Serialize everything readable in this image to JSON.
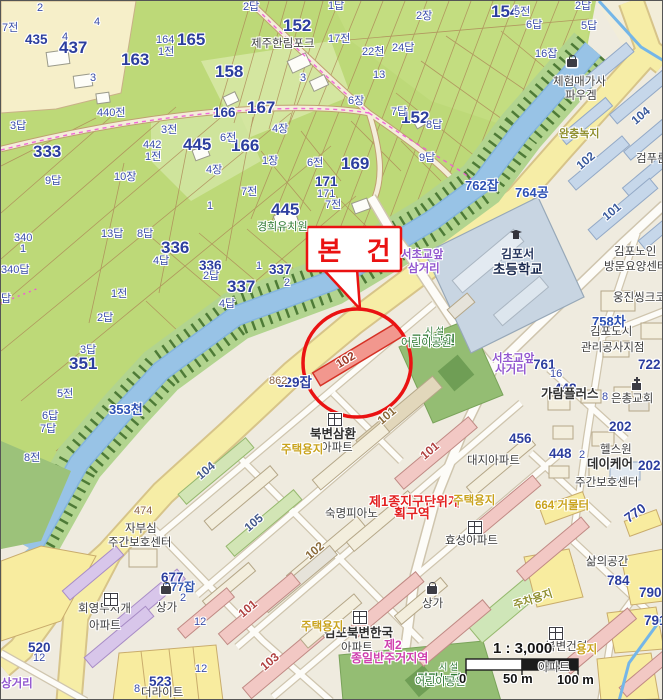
{
  "map": {
    "callout": {
      "label": "본 건"
    },
    "scale": {
      "ratio": "1 : 3,000",
      "zero": "0",
      "mid": "50 m",
      "end": "100 m"
    },
    "palette": {
      "highlight_red": "#ea1212",
      "parcel_fill": "#f2978e",
      "canal_blue": "#98c3e6",
      "farmland_green": "#bdd978",
      "road_yellow": "#f6eda6",
      "parcel_number_blue": "#2c3e9e",
      "zoning_red": "#e32020",
      "zoning_magenta": "#cf3fae",
      "landuse_yellow": "#c9a31d"
    },
    "labels": [
      {
        "t": "437",
        "x": 58,
        "y": 38,
        "c": "pn"
      },
      {
        "t": "435",
        "x": 24,
        "y": 32,
        "c": "pn2"
      },
      {
        "t": "163",
        "x": 120,
        "y": 50,
        "c": "pn"
      },
      {
        "t": "165",
        "x": 176,
        "y": 30,
        "c": "pn"
      },
      {
        "t": "152",
        "x": 282,
        "y": 16,
        "c": "pn"
      },
      {
        "t": "158",
        "x": 214,
        "y": 62,
        "c": "pn"
      },
      {
        "t": "167",
        "x": 246,
        "y": 98,
        "c": "pn"
      },
      {
        "t": "166",
        "x": 230,
        "y": 136,
        "c": "pn"
      },
      {
        "t": "445",
        "x": 182,
        "y": 135,
        "c": "pn"
      },
      {
        "t": "333",
        "x": 32,
        "y": 142,
        "c": "pn"
      },
      {
        "t": "351",
        "x": 68,
        "y": 354,
        "c": "pn"
      },
      {
        "t": "336",
        "x": 160,
        "y": 238,
        "c": "pn"
      },
      {
        "t": "337",
        "x": 226,
        "y": 277,
        "c": "pn"
      },
      {
        "t": "154",
        "x": 490,
        "y": 2,
        "c": "pn"
      },
      {
        "t": "152",
        "x": 400,
        "y": 108,
        "c": "pn"
      },
      {
        "t": "169",
        "x": 340,
        "y": 154,
        "c": "pn"
      },
      {
        "t": "445",
        "x": 270,
        "y": 200,
        "c": "pn"
      },
      {
        "t": "171",
        "x": 314,
        "y": 174,
        "c": "pn2"
      },
      {
        "t": "166",
        "x": 212,
        "y": 105,
        "c": "pn2"
      },
      {
        "t": "336",
        "x": 198,
        "y": 258,
        "c": "pn2"
      },
      {
        "t": "337",
        "x": 268,
        "y": 262,
        "c": "pn2"
      },
      {
        "t": "677",
        "x": 160,
        "y": 570,
        "c": "pn2"
      },
      {
        "t": "677잡",
        "x": 163,
        "y": 580,
        "c": "jmb"
      },
      {
        "t": "523",
        "x": 148,
        "y": 674,
        "c": "pn2"
      },
      {
        "t": "520",
        "x": 27,
        "y": 640,
        "c": "pn2"
      },
      {
        "t": "529잡",
        "x": 276,
        "y": 375,
        "c": "pn2"
      },
      {
        "t": "862",
        "x": 268,
        "y": 375,
        "c": "brn"
      },
      {
        "t": "448",
        "x": 553,
        "y": 381,
        "c": "pn2"
      },
      {
        "t": "448",
        "x": 548,
        "y": 446,
        "c": "pn2"
      },
      {
        "t": "2",
        "x": 578,
        "y": 449,
        "c": "jm"
      },
      {
        "t": "456",
        "x": 508,
        "y": 431,
        "c": "pn2"
      },
      {
        "t": "202",
        "x": 608,
        "y": 419,
        "c": "pn2"
      },
      {
        "t": "202",
        "x": 637,
        "y": 458,
        "c": "pn2"
      },
      {
        "t": "761",
        "x": 532,
        "y": 357,
        "c": "pn2"
      },
      {
        "t": "722",
        "x": 637,
        "y": 357,
        "c": "pn2"
      },
      {
        "t": "770",
        "x": 625,
        "y": 512,
        "c": "pn2",
        "r": -35
      },
      {
        "t": "784",
        "x": 606,
        "y": 573,
        "c": "pn2"
      },
      {
        "t": "790",
        "x": 638,
        "y": 585,
        "c": "pn2"
      },
      {
        "t": "791",
        "x": 643,
        "y": 613,
        "c": "pn2"
      },
      {
        "t": "353천",
        "x": 108,
        "y": 402,
        "c": "blw"
      },
      {
        "t": "762잡",
        "x": 464,
        "y": 178,
        "c": "blw"
      },
      {
        "t": "764공",
        "x": 514,
        "y": 185,
        "c": "blw"
      },
      {
        "t": "758차",
        "x": 591,
        "y": 314,
        "c": "blw"
      },
      {
        "t": "7전",
        "x": 1,
        "y": 22,
        "c": "jm"
      },
      {
        "t": "2답",
        "x": 242,
        "y": 1,
        "c": "jm"
      },
      {
        "t": "2",
        "x": 36,
        "y": 2,
        "c": "jm"
      },
      {
        "t": "3답",
        "x": 9,
        "y": 120,
        "c": "jm"
      },
      {
        "t": "440전",
        "x": 96,
        "y": 107,
        "c": "jm"
      },
      {
        "t": "3전",
        "x": 160,
        "y": 124,
        "c": "jm"
      },
      {
        "t": "9답",
        "x": 44,
        "y": 175,
        "c": "jm"
      },
      {
        "t": "10장",
        "x": 113,
        "y": 171,
        "c": "jm"
      },
      {
        "t": "7전",
        "x": 240,
        "y": 186,
        "c": "jm"
      },
      {
        "t": "4장",
        "x": 271,
        "y": 123,
        "c": "jm"
      },
      {
        "t": "6전",
        "x": 219,
        "y": 132,
        "c": "jm"
      },
      {
        "t": "1장",
        "x": 261,
        "y": 155,
        "c": "jm"
      },
      {
        "t": "6전",
        "x": 306,
        "y": 157,
        "c": "jm"
      },
      {
        "t": "4장",
        "x": 205,
        "y": 164,
        "c": "jm"
      },
      {
        "t": "13답",
        "x": 100,
        "y": 228,
        "c": "jm"
      },
      {
        "t": "8답",
        "x": 136,
        "y": 228,
        "c": "jm"
      },
      {
        "t": "4답",
        "x": 152,
        "y": 255,
        "c": "jm"
      },
      {
        "t": "2답",
        "x": 202,
        "y": 270,
        "c": "jm"
      },
      {
        "t": "4답",
        "x": 218,
        "y": 298,
        "c": "jm"
      },
      {
        "t": "1",
        "x": 255,
        "y": 260,
        "c": "jm"
      },
      {
        "t": "2",
        "x": 283,
        "y": 277,
        "c": "jm"
      },
      {
        "t": "340",
        "x": 13,
        "y": 232,
        "c": "jm"
      },
      {
        "t": "1",
        "x": 19,
        "y": 243,
        "c": "jm"
      },
      {
        "t": "340답",
        "x": 0,
        "y": 264,
        "c": "jm"
      },
      {
        "t": "답",
        "x": 0,
        "y": 293,
        "c": "jm"
      },
      {
        "t": "1전",
        "x": 110,
        "y": 288,
        "c": "jm"
      },
      {
        "t": "2답",
        "x": 96,
        "y": 312,
        "c": "jm"
      },
      {
        "t": "3답",
        "x": 79,
        "y": 344,
        "c": "jm"
      },
      {
        "t": "5전",
        "x": 56,
        "y": 388,
        "c": "jm"
      },
      {
        "t": "6답",
        "x": 41,
        "y": 410,
        "c": "jm"
      },
      {
        "t": "7답",
        "x": 39,
        "y": 423,
        "c": "jm"
      },
      {
        "t": "8전",
        "x": 23,
        "y": 452,
        "c": "jm"
      },
      {
        "t": "17전",
        "x": 327,
        "y": 33,
        "c": "jm"
      },
      {
        "t": "22천",
        "x": 361,
        "y": 46,
        "c": "jm"
      },
      {
        "t": "24답",
        "x": 391,
        "y": 42,
        "c": "jm"
      },
      {
        "t": "13",
        "x": 372,
        "y": 69,
        "c": "jm"
      },
      {
        "t": "6장",
        "x": 347,
        "y": 95,
        "c": "jm"
      },
      {
        "t": "7답",
        "x": 390,
        "y": 106,
        "c": "jm"
      },
      {
        "t": "8답",
        "x": 425,
        "y": 119,
        "c": "jm"
      },
      {
        "t": "9답",
        "x": 418,
        "y": 152,
        "c": "jm"
      },
      {
        "t": "1답",
        "x": 327,
        "y": 0,
        "c": "jm"
      },
      {
        "t": "2장",
        "x": 415,
        "y": 10,
        "c": "jm"
      },
      {
        "t": "5전",
        "x": 513,
        "y": 6,
        "c": "jm"
      },
      {
        "t": "6답",
        "x": 525,
        "y": 19,
        "c": "jm"
      },
      {
        "t": "16잡",
        "x": 534,
        "y": 48,
        "c": "jm"
      },
      {
        "t": "5답",
        "x": 580,
        "y": 20,
        "c": "jm"
      },
      {
        "t": "2답",
        "x": 574,
        "y": 0,
        "c": "jm"
      },
      {
        "t": "164",
        "x": 155,
        "y": 34,
        "c": "jm"
      },
      {
        "t": "1전",
        "x": 157,
        "y": 46,
        "c": "jm"
      },
      {
        "t": "442",
        "x": 142,
        "y": 139,
        "c": "jm"
      },
      {
        "t": "1전",
        "x": 144,
        "y": 151,
        "c": "jm"
      },
      {
        "t": "1",
        "x": 206,
        "y": 200,
        "c": "jm"
      },
      {
        "t": "3",
        "x": 89,
        "y": 72,
        "c": "jm"
      },
      {
        "t": "3",
        "x": 299,
        "y": 72,
        "c": "jm"
      },
      {
        "t": "4",
        "x": 93,
        "y": 16,
        "c": "jm"
      },
      {
        "t": "4",
        "x": 61,
        "y": 31,
        "c": "jm"
      },
      {
        "t": "171",
        "x": 316,
        "y": 188,
        "c": "jm"
      },
      {
        "t": "7전",
        "x": 324,
        "y": 199,
        "c": "jm"
      },
      {
        "t": "16",
        "x": 549,
        "y": 368,
        "c": "jm"
      },
      {
        "t": "8",
        "x": 601,
        "y": 391,
        "c": "jm"
      },
      {
        "t": "8",
        "x": 133,
        "y": 683,
        "c": "jm"
      },
      {
        "t": "12",
        "x": 32,
        "y": 652,
        "c": "jm"
      },
      {
        "t": "12",
        "x": 194,
        "y": 663,
        "c": "jm"
      },
      {
        "t": "12",
        "x": 193,
        "y": 616,
        "c": "jm"
      },
      {
        "t": "2",
        "x": 179,
        "y": 592,
        "c": "jm"
      },
      {
        "t": "474",
        "x": 133,
        "y": 505,
        "c": "brn"
      },
      {
        "t": "104",
        "x": 197,
        "y": 470,
        "c": "bl",
        "r": -40,
        "col": "#44598c"
      },
      {
        "t": "105",
        "x": 245,
        "y": 522,
        "c": "bl",
        "r": -40,
        "col": "#44598c"
      },
      {
        "t": "101",
        "x": 378,
        "y": 415,
        "c": "bl",
        "r": -40,
        "col": "#8a6a3a"
      },
      {
        "t": "101",
        "x": 421,
        "y": 450,
        "c": "bl",
        "r": -40,
        "col": "#b04040"
      },
      {
        "t": "102",
        "x": 306,
        "y": 550,
        "c": "bl",
        "r": -40,
        "col": "#8a6a3a"
      },
      {
        "t": "101",
        "x": 239,
        "y": 608,
        "c": "bl",
        "r": -40,
        "col": "#b04040"
      },
      {
        "t": "103",
        "x": 261,
        "y": 661,
        "c": "bl",
        "r": -40,
        "col": "#b04040"
      },
      {
        "t": "104",
        "x": 632,
        "y": 115,
        "c": "bl",
        "r": -40,
        "col": "#3a5a9c"
      },
      {
        "t": "102",
        "x": 577,
        "y": 160,
        "c": "bl",
        "r": -40,
        "col": "#3a5a9c"
      },
      {
        "t": "101",
        "x": 603,
        "y": 211,
        "c": "bl",
        "r": -40,
        "col": "#3a5a9c"
      },
      {
        "t": "102",
        "x": 336,
        "y": 358,
        "c": "bl",
        "r": -31,
        "col": "#a03a28"
      },
      {
        "t": "제주한림포크",
        "x": 250,
        "y": 38,
        "c": "poi"
      },
      {
        "t": "경희유치원",
        "x": 256,
        "y": 221,
        "c": "grn"
      },
      {
        "t": "체험매가사",
        "x": 552,
        "y": 76,
        "c": "poi"
      },
      {
        "t": "파우겜",
        "x": 564,
        "y": 90,
        "c": "poi"
      },
      {
        "t": "김포서",
        "x": 500,
        "y": 247,
        "c": "sch"
      },
      {
        "t": "초등학교",
        "x": 492,
        "y": 262,
        "c": "schb"
      },
      {
        "t": "김포노인",
        "x": 613,
        "y": 246,
        "c": "poi"
      },
      {
        "t": "방문요양센터",
        "x": 603,
        "y": 261,
        "c": "poi"
      },
      {
        "t": "웅진씽크코리아",
        "x": 612,
        "y": 292,
        "c": "poi"
      },
      {
        "t": "김포도시",
        "x": 589,
        "y": 326,
        "c": "poi"
      },
      {
        "t": "관리공사지점",
        "x": 580,
        "y": 342,
        "c": "poi"
      },
      {
        "t": "가람플러스",
        "x": 540,
        "y": 387,
        "c": "poib"
      },
      {
        "t": "은총교회",
        "x": 610,
        "y": 393,
        "c": "poi"
      },
      {
        "t": "헬스원",
        "x": 599,
        "y": 444,
        "c": "poi"
      },
      {
        "t": "데이케어",
        "x": 586,
        "y": 457,
        "c": "poib"
      },
      {
        "t": "주간보호센터",
        "x": 574,
        "y": 477,
        "c": "poi"
      },
      {
        "t": "대지아파트",
        "x": 466,
        "y": 455,
        "c": "poi"
      },
      {
        "t": "숙명피아노",
        "x": 324,
        "y": 508,
        "c": "poi"
      },
      {
        "t": "효성아파트",
        "x": 444,
        "y": 535,
        "c": "poi"
      },
      {
        "t": "북변삼환",
        "x": 309,
        "y": 427,
        "c": "poib"
      },
      {
        "t": "아파트",
        "x": 320,
        "y": 442,
        "c": "poi"
      },
      {
        "t": "김포북변한국",
        "x": 323,
        "y": 626,
        "c": "poib"
      },
      {
        "t": "아파트",
        "x": 340,
        "y": 642,
        "c": "poi"
      },
      {
        "t": "회영무지개",
        "x": 77,
        "y": 603,
        "c": "poi"
      },
      {
        "t": "아파트",
        "x": 88,
        "y": 620,
        "c": "poi"
      },
      {
        "t": "자부심",
        "x": 124,
        "y": 523,
        "c": "poi"
      },
      {
        "t": "주간보호센터",
        "x": 107,
        "y": 537,
        "c": "poi"
      },
      {
        "t": "상가",
        "x": 155,
        "y": 602,
        "c": "poi"
      },
      {
        "t": "상가",
        "x": 421,
        "y": 598,
        "c": "poi"
      },
      {
        "t": "북변건영",
        "x": 544,
        "y": 641,
        "c": "poi"
      },
      {
        "t": "아파트",
        "x": 537,
        "y": 662,
        "c": "poi"
      },
      {
        "t": "삶의공간",
        "x": 585,
        "y": 556,
        "c": "poi"
      },
      {
        "t": "더라이트",
        "x": 140,
        "y": 687,
        "c": "poi"
      },
      {
        "t": "검푸른",
        "x": 635,
        "y": 153,
        "c": "poi"
      },
      {
        "t": "서초교앞",
        "x": 400,
        "y": 249,
        "c": "pur"
      },
      {
        "t": "삼거리",
        "x": 407,
        "y": 263,
        "c": "pur"
      },
      {
        "t": "서초교앞",
        "x": 491,
        "y": 353,
        "c": "pur"
      },
      {
        "t": "사거리",
        "x": 494,
        "y": 364,
        "c": "pur"
      },
      {
        "t": "상거리",
        "x": 0,
        "y": 678,
        "c": "pur"
      },
      {
        "t": "근린공원",
        "x": 410,
        "y": 333,
        "c": "grnb"
      },
      {
        "t": "어린이공원",
        "x": 400,
        "y": 337,
        "c": "grn"
      },
      {
        "t": "시 설",
        "x": 424,
        "y": 326,
        "c": "grns"
      },
      {
        "t": "경관녹지",
        "x": 416,
        "y": 672,
        "c": "grnb"
      },
      {
        "t": "어린이공원",
        "x": 414,
        "y": 676,
        "c": "grn"
      },
      {
        "t": "시 설",
        "x": 438,
        "y": 662,
        "c": "grns"
      },
      {
        "t": "제1종지구단위계",
        "x": 368,
        "y": 494,
        "c": "redz"
      },
      {
        "t": "획구역",
        "x": 393,
        "y": 506,
        "c": "redz"
      },
      {
        "t": "제2",
        "x": 383,
        "y": 638,
        "c": "mag"
      },
      {
        "t": "종일반주거지역",
        "x": 350,
        "y": 651,
        "c": "mag"
      },
      {
        "t": "주택용지",
        "x": 280,
        "y": 444,
        "c": "yel"
      },
      {
        "t": "주택용지",
        "x": 452,
        "y": 495,
        "c": "yel"
      },
      {
        "t": "주택용지",
        "x": 300,
        "y": 621,
        "c": "yel"
      },
      {
        "t": "664 거물터",
        "x": 534,
        "y": 500,
        "c": "yel"
      },
      {
        "t": "용지",
        "x": 575,
        "y": 644,
        "c": "yel"
      },
      {
        "t": "완충녹지",
        "x": 558,
        "y": 128,
        "c": "olv"
      },
      {
        "t": "주차용지",
        "x": 513,
        "y": 600,
        "c": "olv",
        "r": -18
      }
    ],
    "icons": [
      {
        "type": "apartment",
        "x": 327,
        "y": 412
      },
      {
        "type": "apartment",
        "x": 467,
        "y": 520
      },
      {
        "type": "apartment",
        "x": 352,
        "y": 610
      },
      {
        "type": "apartment",
        "x": 103,
        "y": 592
      },
      {
        "type": "apartment",
        "x": 548,
        "y": 626
      },
      {
        "type": "school",
        "x": 508,
        "y": 228
      },
      {
        "type": "church",
        "x": 631,
        "y": 382
      },
      {
        "type": "shop",
        "x": 566,
        "y": 58
      },
      {
        "type": "shop",
        "x": 160,
        "y": 585
      },
      {
        "type": "shop",
        "x": 426,
        "y": 585
      }
    ]
  }
}
